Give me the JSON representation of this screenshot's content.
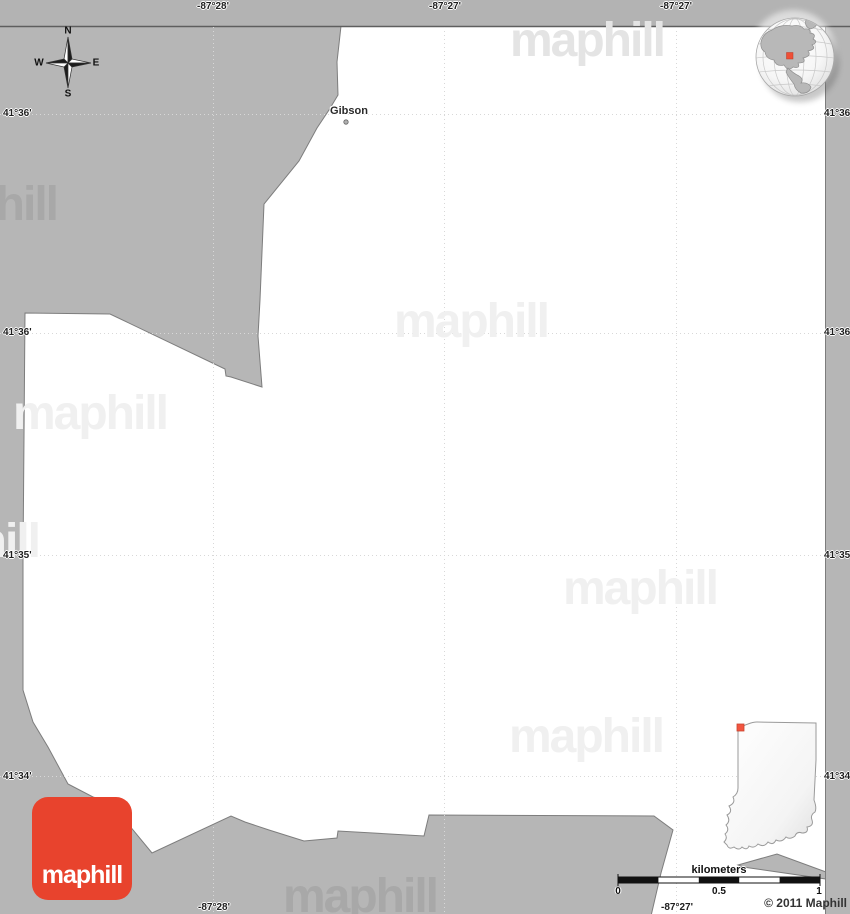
{
  "place": {
    "name": "Gibson"
  },
  "compass": {
    "north": "N",
    "east": "E",
    "south": "S",
    "west": "W"
  },
  "graticule": {
    "top": [
      "-87°28'",
      "-87°27'",
      "-87°27'"
    ],
    "bottom": [
      "-87°28'",
      "-87°27'"
    ],
    "left": [
      "41°36'",
      "41°36'",
      "41°35'",
      "41°34'"
    ],
    "right": [
      "41°36'",
      "41°36'",
      "41°35'",
      "41°34'"
    ]
  },
  "scale_bar": {
    "unit_label": "kilometers",
    "tick_labels": [
      "0",
      "0.5",
      "1"
    ]
  },
  "branding": {
    "logo_text": "maphill",
    "watermark_text": "maphill",
    "copyright": "© 2011 Maphill"
  },
  "colors": {
    "land_gray": "#b6b6b6",
    "border_gray": "#7d7d7d",
    "accent_red": "#e8432d",
    "marker_red": "#f25540",
    "map_white": "#ffffff"
  }
}
